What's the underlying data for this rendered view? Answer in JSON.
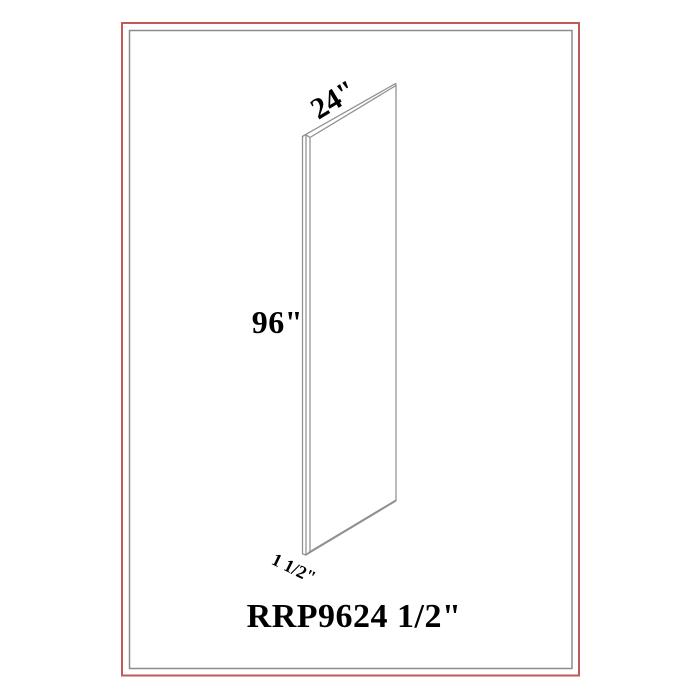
{
  "diagram": {
    "type": "cabinet-panel-isometric-drawing",
    "product_code": "RRP9624 1/2\"",
    "dimensions": {
      "width": "24\"",
      "height": "96\"",
      "thickness": "1 1/2\""
    }
  },
  "colors": {
    "outer_border": "#c35858",
    "inner_border": "#8c8c8c",
    "drawing_line": "#909090",
    "panel_fill": "#ffffff",
    "text": "#000000",
    "background": "#ffffff"
  }
}
